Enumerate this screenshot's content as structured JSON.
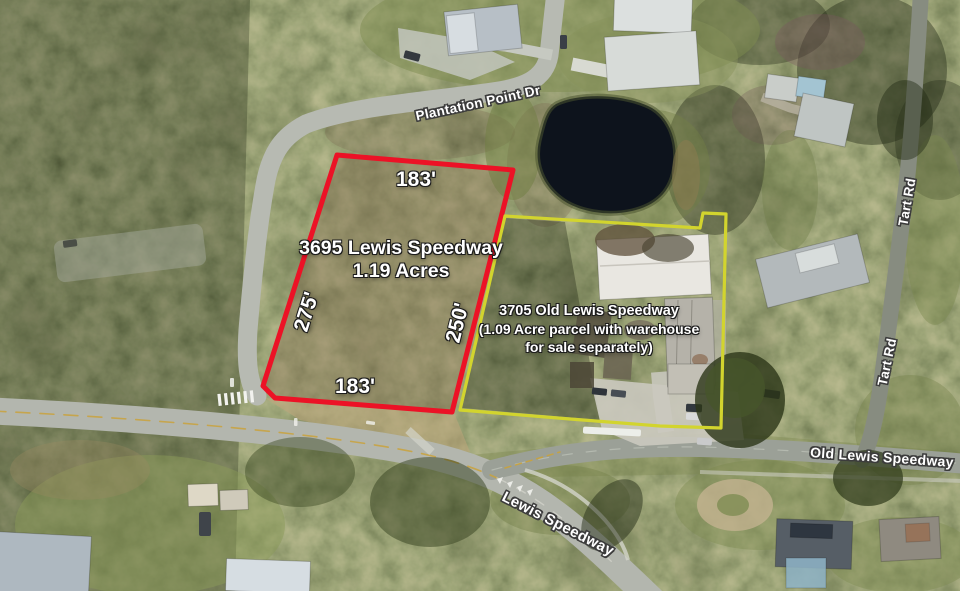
{
  "scene": {
    "description": "Aerial satellite photo of wooded parcels at a road junction with listing annotations",
    "colors": {
      "red_outline": "#ec1226",
      "yellow_outline": "#d2d42e",
      "label_text": "#ffffff",
      "road_label_halo": "#3c3c3c",
      "pond": "#0d131c"
    }
  },
  "annotations": {
    "parcel_red": {
      "address": "3695 Lewis Speedway",
      "acreage": "1.19 Acres",
      "outline_color": "#ec1226",
      "dim_top": "183'",
      "dim_left": "275'",
      "dim_right": "250'",
      "dim_bottom": "183'"
    },
    "parcel_yellow": {
      "address": "3705 Old Lewis Speedway",
      "note_line1": "(1.09 Acre parcel with warehouse",
      "note_line2": "for sale separately)",
      "outline_color": "#d2d42e"
    }
  },
  "road_labels": {
    "plantation_point_dr": "Plantation Point Dr",
    "tart_rd_north": "Tart Rd",
    "tart_rd_south": "Tart Rd",
    "old_lewis_speedway": "Old Lewis Speedway",
    "lewis_speedway": "Lewis Speedway"
  }
}
